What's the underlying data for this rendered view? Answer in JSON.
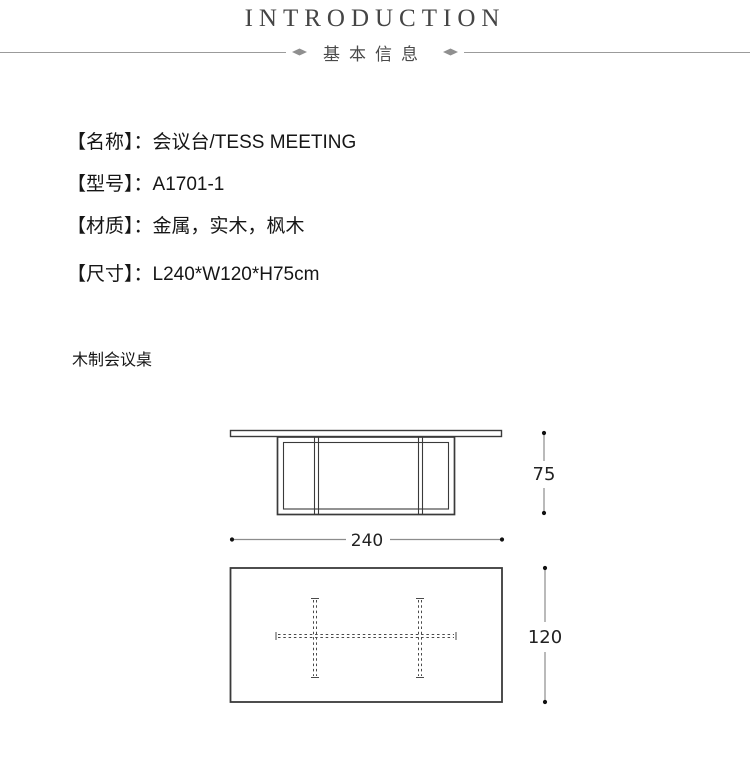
{
  "header": {
    "title": "INTRODUCTION",
    "subtitle": "基本信息"
  },
  "specs": {
    "separator": "：",
    "rows": [
      {
        "label": "【名称】",
        "value": "会议台/TESS MEETING"
      },
      {
        "label": "【型号】",
        "value": "A1701-1"
      },
      {
        "label": "【材质】",
        "value": "金属，实木，枫木"
      },
      {
        "label": "【尺寸】",
        "value": "L240*W120*H75cm"
      }
    ]
  },
  "note": "木制会议桌",
  "diagram": {
    "front_view": {
      "width_label": "240",
      "height_label": "75"
    },
    "top_view": {
      "depth_label": "120"
    }
  },
  "colors": {
    "divider_line": "#9b9b9b",
    "drawing_line": "#3a3a3a",
    "dimension_line": "#8c8c8c",
    "body_text": "#161616",
    "title_text": "#454545"
  }
}
